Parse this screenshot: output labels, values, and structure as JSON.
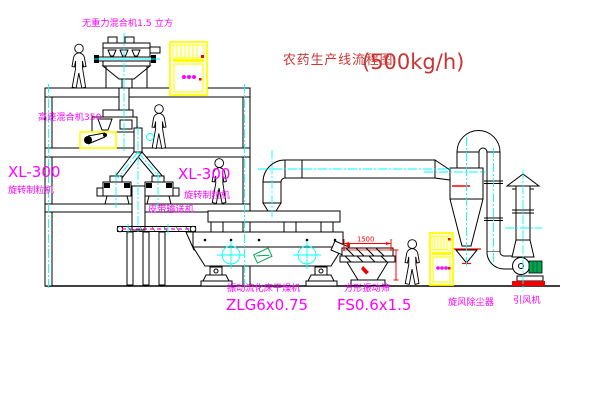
{
  "title": {
    "cn": "农药生产线流程图",
    "capacity": "(500kg/h)"
  },
  "labels": {
    "gravity_mixer": "无重力混合机1.5 立方",
    "high_speed_mixer": "高速混合机350",
    "granulator_model": "XL-300",
    "granulator_name": "旋转制粒机",
    "belt_conveyor": "皮带输送机",
    "dryer_name": "振动流化床干燥机",
    "dryer_model": "ZLG6x0.75",
    "screen_name": "方形振动筛",
    "screen_model": "FS0.6x1.5",
    "cyclone_name": "旋风除尘器",
    "fan_name": "引风机"
  },
  "dimensions": {
    "screen_width": "1500"
  },
  "colors": {
    "label": "#ff00ff",
    "title": "#cc3333",
    "centerline": "#00ffff",
    "cabinet": "#ffff00",
    "dimension": "#ff0000",
    "motor": "#00a550"
  }
}
